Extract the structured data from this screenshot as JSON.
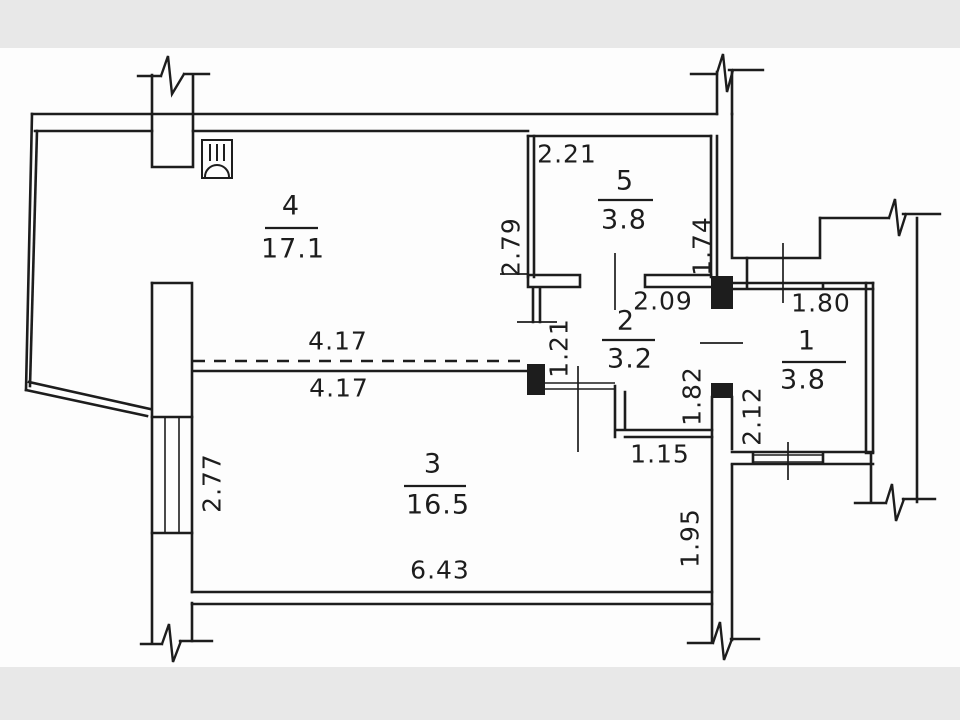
{
  "page": {
    "kind": "apartment floor plan drawing",
    "background": "#fdfdfd",
    "margin_bar_color": "#e8e8e8",
    "line_color": "#1d1d1d"
  },
  "floor_plan": {
    "rooms": [
      {
        "number": "4",
        "area": "17.1"
      },
      {
        "number": "5",
        "area": "3.8"
      },
      {
        "number": "2",
        "area": "3.2"
      },
      {
        "number": "1",
        "area": "3.8"
      },
      {
        "number": "3",
        "area": "16.5"
      }
    ],
    "dimensions": {
      "d_2_21": "2.21",
      "d_2_79": "2.79",
      "d_1_74": "1.74",
      "d_2_09": "2.09",
      "d_1_80": "1.80",
      "d_4_17_upper": "4.17",
      "d_4_17_lower": "4.17",
      "d_1_21": "1.21",
      "d_1_82": "1.82",
      "d_2_12": "2.12",
      "d_1_15": "1.15",
      "d_2_77": "2.77",
      "d_6_43": "6.43",
      "d_1_95": "1.95"
    },
    "icons": [
      {
        "name": "ventilation-duct-icon"
      }
    ],
    "symbols": [
      "wall-break",
      "window",
      "door-opening",
      "dashed-removed-wall"
    ]
  }
}
